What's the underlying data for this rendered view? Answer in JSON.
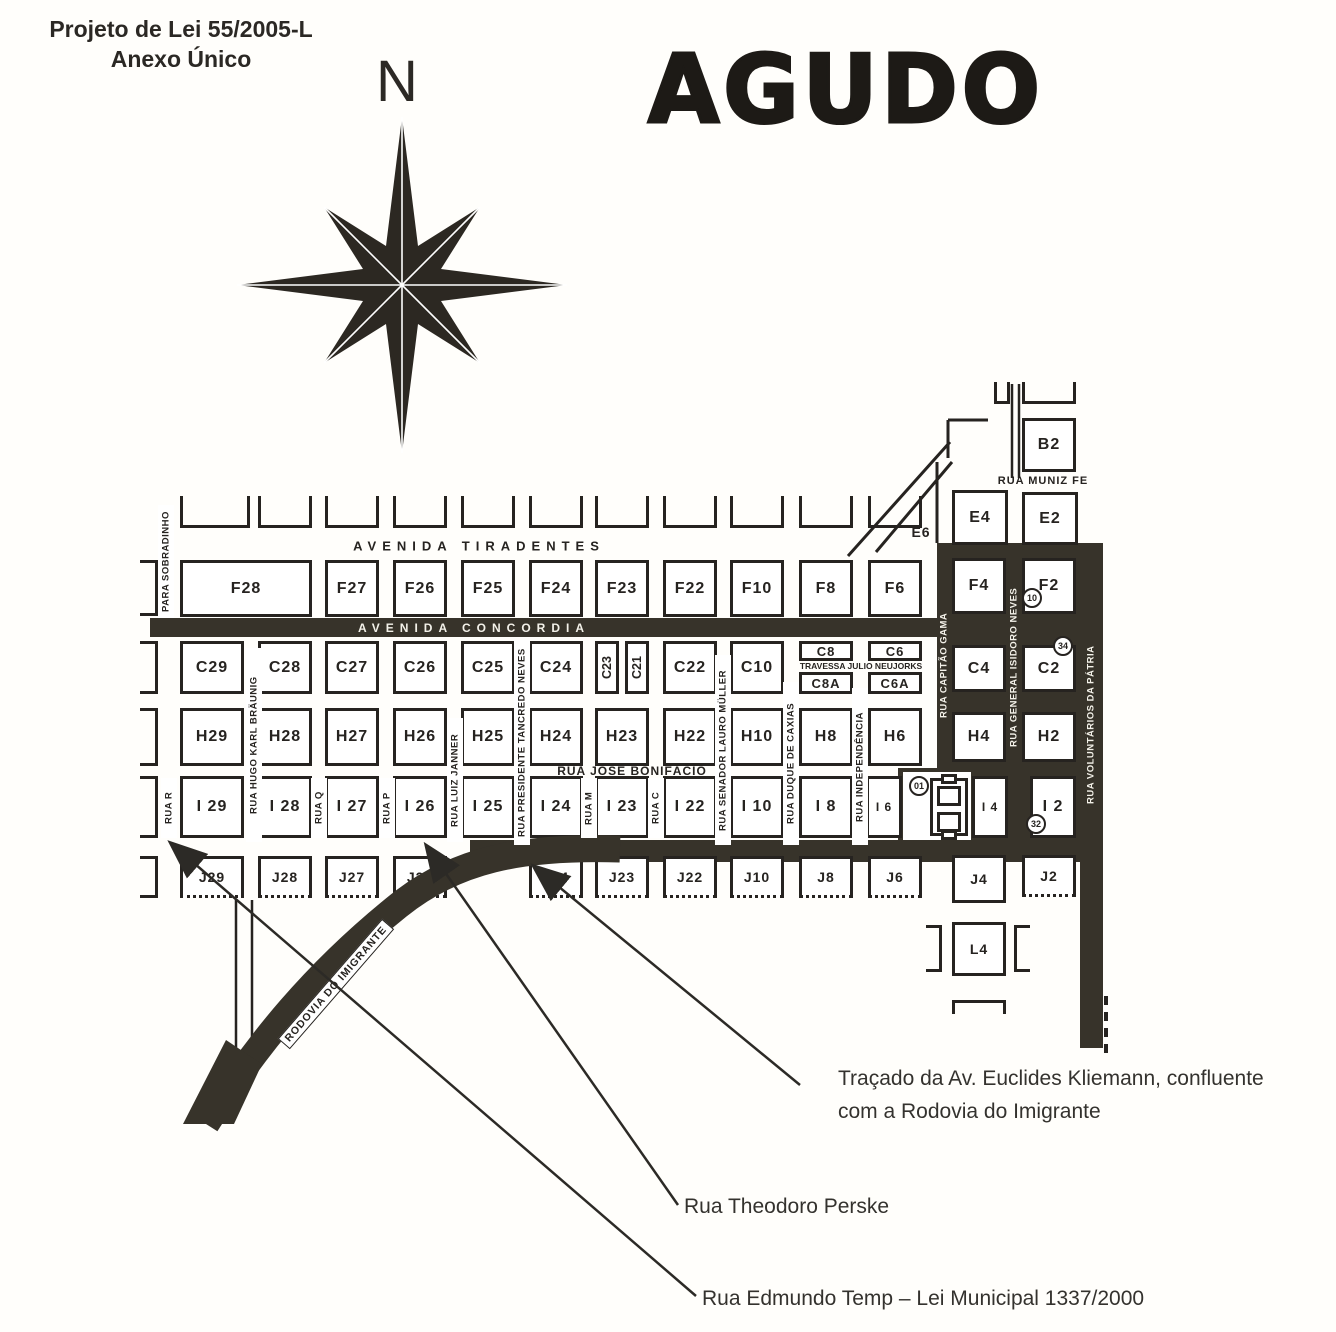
{
  "page": {
    "law_line1": "Projeto de Lei 55/2005-L",
    "law_line2": "Anexo Único",
    "city_title": "AGUDO",
    "compass_letter": "N"
  },
  "map": {
    "ink_color": "#262320",
    "road_color": "#37332a",
    "blocks": [
      {
        "label": "B2",
        "x": 1022,
        "y": 418,
        "w": 54,
        "h": 54
      },
      {
        "label": "E4",
        "x": 952,
        "y": 490,
        "w": 56,
        "h": 55
      },
      {
        "label": "E2",
        "x": 1022,
        "y": 492,
        "w": 56,
        "h": 53
      },
      {
        "label": "F28",
        "x": 180,
        "y": 560,
        "w": 132,
        "h": 57
      },
      {
        "label": "F27",
        "x": 325,
        "y": 560,
        "w": 54,
        "h": 57
      },
      {
        "label": "F26",
        "x": 393,
        "y": 560,
        "w": 54,
        "h": 57
      },
      {
        "label": "F25",
        "x": 461,
        "y": 560,
        "w": 54,
        "h": 57
      },
      {
        "label": "F24",
        "x": 529,
        "y": 560,
        "w": 54,
        "h": 57
      },
      {
        "label": "F23",
        "x": 595,
        "y": 560,
        "w": 54,
        "h": 57
      },
      {
        "label": "F22",
        "x": 663,
        "y": 560,
        "w": 54,
        "h": 57
      },
      {
        "label": "F10",
        "x": 730,
        "y": 560,
        "w": 54,
        "h": 57
      },
      {
        "label": "F8",
        "x": 799,
        "y": 560,
        "w": 54,
        "h": 57
      },
      {
        "label": "F6",
        "x": 868,
        "y": 560,
        "w": 54,
        "h": 57
      },
      {
        "label": "F4",
        "x": 952,
        "y": 558,
        "w": 54,
        "h": 56
      },
      {
        "label": "F2",
        "x": 1022,
        "y": 558,
        "w": 54,
        "h": 56
      },
      {
        "label": "C29",
        "x": 180,
        "y": 641,
        "w": 64,
        "h": 53
      },
      {
        "label": "C28",
        "x": 258,
        "y": 641,
        "w": 54,
        "h": 53
      },
      {
        "label": "C27",
        "x": 325,
        "y": 641,
        "w": 54,
        "h": 53
      },
      {
        "label": "C26",
        "x": 393,
        "y": 641,
        "w": 54,
        "h": 53
      },
      {
        "label": "C25",
        "x": 461,
        "y": 641,
        "w": 54,
        "h": 53
      },
      {
        "label": "C24",
        "x": 529,
        "y": 641,
        "w": 54,
        "h": 53
      },
      {
        "label": "C23",
        "x": 595,
        "y": 641,
        "w": 24,
        "h": 53,
        "vert": true
      },
      {
        "label": "C21",
        "x": 625,
        "y": 641,
        "w": 24,
        "h": 53,
        "vert": true
      },
      {
        "label": "C22",
        "x": 663,
        "y": 641,
        "w": 54,
        "h": 53
      },
      {
        "label": "C10",
        "x": 730,
        "y": 641,
        "w": 54,
        "h": 53
      },
      {
        "label": "C8",
        "x": 799,
        "y": 641,
        "w": 54,
        "h": 20,
        "fs": 13
      },
      {
        "label": "C8A",
        "x": 799,
        "y": 672,
        "w": 54,
        "h": 22,
        "fs": 13
      },
      {
        "label": "C6",
        "x": 868,
        "y": 641,
        "w": 54,
        "h": 20,
        "fs": 13
      },
      {
        "label": "C6A",
        "x": 868,
        "y": 672,
        "w": 54,
        "h": 22,
        "fs": 13
      },
      {
        "label": "C4",
        "x": 952,
        "y": 645,
        "w": 54,
        "h": 47
      },
      {
        "label": "C2",
        "x": 1022,
        "y": 645,
        "w": 54,
        "h": 47
      },
      {
        "label": "H29",
        "x": 180,
        "y": 708,
        "w": 64,
        "h": 58
      },
      {
        "label": "H28",
        "x": 258,
        "y": 708,
        "w": 54,
        "h": 58
      },
      {
        "label": "H27",
        "x": 325,
        "y": 708,
        "w": 54,
        "h": 58
      },
      {
        "label": "H26",
        "x": 393,
        "y": 708,
        "w": 54,
        "h": 58
      },
      {
        "label": "H25",
        "x": 461,
        "y": 708,
        "w": 54,
        "h": 58
      },
      {
        "label": "H24",
        "x": 529,
        "y": 708,
        "w": 54,
        "h": 58
      },
      {
        "label": "H23",
        "x": 595,
        "y": 708,
        "w": 54,
        "h": 58
      },
      {
        "label": "H22",
        "x": 663,
        "y": 708,
        "w": 54,
        "h": 58
      },
      {
        "label": "H10",
        "x": 730,
        "y": 708,
        "w": 54,
        "h": 58
      },
      {
        "label": "H8",
        "x": 799,
        "y": 708,
        "w": 54,
        "h": 58
      },
      {
        "label": "H6",
        "x": 868,
        "y": 708,
        "w": 54,
        "h": 58
      },
      {
        "label": "H4",
        "x": 952,
        "y": 712,
        "w": 54,
        "h": 50
      },
      {
        "label": "H2",
        "x": 1022,
        "y": 712,
        "w": 54,
        "h": 50
      },
      {
        "label": "I 29",
        "x": 180,
        "y": 776,
        "w": 64,
        "h": 62
      },
      {
        "label": "I 28",
        "x": 258,
        "y": 776,
        "w": 54,
        "h": 62
      },
      {
        "label": "I 27",
        "x": 325,
        "y": 776,
        "w": 54,
        "h": 62
      },
      {
        "label": "I 26",
        "x": 393,
        "y": 776,
        "w": 54,
        "h": 62
      },
      {
        "label": "I 25",
        "x": 461,
        "y": 776,
        "w": 54,
        "h": 62
      },
      {
        "label": "I 24",
        "x": 529,
        "y": 776,
        "w": 54,
        "h": 62
      },
      {
        "label": "I 23",
        "x": 595,
        "y": 776,
        "w": 54,
        "h": 62
      },
      {
        "label": "I 22",
        "x": 663,
        "y": 776,
        "w": 54,
        "h": 62
      },
      {
        "label": "I 10",
        "x": 730,
        "y": 776,
        "w": 54,
        "h": 62
      },
      {
        "label": "I 8",
        "x": 799,
        "y": 776,
        "w": 54,
        "h": 62
      },
      {
        "label": "I 6",
        "x": 866,
        "y": 776,
        "w": 36,
        "h": 62,
        "fs": 12
      },
      {
        "label": "I 4",
        "x": 972,
        "y": 776,
        "w": 36,
        "h": 62,
        "fs": 12
      },
      {
        "label": "I 2",
        "x": 1030,
        "y": 776,
        "w": 46,
        "h": 62
      },
      {
        "label": "J29",
        "x": 180,
        "y": 856,
        "w": 64,
        "h": 42,
        "dotted": true,
        "fs": 14
      },
      {
        "label": "J28",
        "x": 258,
        "y": 856,
        "w": 54,
        "h": 42,
        "dotted": true,
        "fs": 14
      },
      {
        "label": "J27",
        "x": 325,
        "y": 856,
        "w": 54,
        "h": 42,
        "dotted": true,
        "fs": 14
      },
      {
        "label": "J26",
        "x": 393,
        "y": 856,
        "w": 54,
        "h": 42,
        "dotted": true,
        "fs": 14
      },
      {
        "label": "J24",
        "x": 529,
        "y": 856,
        "w": 54,
        "h": 42,
        "dotted": true,
        "fs": 14
      },
      {
        "label": "J23",
        "x": 595,
        "y": 856,
        "w": 54,
        "h": 42,
        "dotted": true,
        "fs": 14
      },
      {
        "label": "J22",
        "x": 663,
        "y": 856,
        "w": 54,
        "h": 42,
        "dotted": true,
        "fs": 14
      },
      {
        "label": "J10",
        "x": 730,
        "y": 856,
        "w": 54,
        "h": 42,
        "dotted": true,
        "fs": 14
      },
      {
        "label": "J8",
        "x": 799,
        "y": 856,
        "w": 54,
        "h": 42,
        "dotted": true,
        "fs": 14
      },
      {
        "label": "J6",
        "x": 868,
        "y": 856,
        "w": 54,
        "h": 42,
        "dotted": true,
        "fs": 14
      },
      {
        "label": "J4",
        "x": 952,
        "y": 855,
        "w": 54,
        "h": 48,
        "fs": 14
      },
      {
        "label": "J2",
        "x": 1022,
        "y": 855,
        "w": 54,
        "h": 42,
        "dotted": true,
        "fs": 14
      },
      {
        "label": "L4",
        "x": 952,
        "y": 922,
        "w": 54,
        "h": 54,
        "fs": 14
      }
    ],
    "horizontal_labels": [
      {
        "id": "avenida-tiradentes",
        "text": "AVENIDA   TIRADENTES",
        "x": 479,
        "y": 546,
        "size": 13,
        "ls": 6,
        "color": "dark"
      },
      {
        "id": "avenida-concordia",
        "text": "AVENIDA   CONCORDIA",
        "x": 474,
        "y": 628,
        "size": 12,
        "ls": 6,
        "color": "light"
      },
      {
        "id": "rua-jose-bonifacio",
        "text": "RUA JOSÉ BONIFÁCIO",
        "x": 632,
        "y": 771,
        "size": 12,
        "ls": 1,
        "color": "dark"
      },
      {
        "id": "rua-muniz-fe",
        "text": "RUA MUNIZ FE",
        "x": 1043,
        "y": 481,
        "size": 11,
        "ls": 1,
        "color": "dark"
      },
      {
        "id": "travessa-julio-neujorks",
        "text": "TRAVESSA JULIO NEUJORKS",
        "x": 861,
        "y": 666,
        "size": 8.5,
        "ls": 0,
        "color": "dark"
      },
      {
        "id": "quadra-e6",
        "text": "E6",
        "x": 921,
        "y": 532,
        "size": 14,
        "ls": 1,
        "color": "dark"
      }
    ],
    "vertical_labels": [
      {
        "id": "para-sobradinho",
        "text": "PARA SOBRADINHO",
        "x": 166,
        "y1": 505,
        "y2": 618,
        "color": "dark"
      },
      {
        "id": "rua-r",
        "text": "RUA R",
        "x": 169,
        "y1": 778,
        "y2": 838,
        "color": "dark"
      },
      {
        "id": "rua-hugo-karl-braunig",
        "text": "RUA HUGO KARL BRÄUNIG",
        "x": 254,
        "y1": 648,
        "y2": 842,
        "color": "dark"
      },
      {
        "id": "rua-q",
        "text": "RUA Q",
        "x": 319,
        "y1": 778,
        "y2": 838,
        "color": "dark"
      },
      {
        "id": "rua-p",
        "text": "RUA P",
        "x": 387,
        "y1": 778,
        "y2": 838,
        "color": "dark"
      },
      {
        "id": "rua-luiz-janner",
        "text": "RUA LUIZ JANNER",
        "x": 455,
        "y1": 718,
        "y2": 842,
        "color": "dark"
      },
      {
        "id": "rua-presidente-tancredo-neves",
        "text": "RUA PRESIDENTE TANCREDO NEVES",
        "x": 522,
        "y1": 640,
        "y2": 845,
        "color": "dark"
      },
      {
        "id": "rua-m",
        "text": "RUA M",
        "x": 589,
        "y1": 778,
        "y2": 838,
        "color": "dark"
      },
      {
        "id": "rua-c",
        "text": "RUA C",
        "x": 656,
        "y1": 778,
        "y2": 838,
        "color": "dark"
      },
      {
        "id": "rua-senador-lauro-muller",
        "text": "RUA SENADOR LAURO MÜLLER",
        "x": 723,
        "y1": 655,
        "y2": 845,
        "color": "dark"
      },
      {
        "id": "rua-duque-de-caxias",
        "text": "RUA DUQUE DE CAXIAS",
        "x": 791,
        "y1": 682,
        "y2": 845,
        "color": "dark"
      },
      {
        "id": "rua-independencia",
        "text": "RUA INDEPENDÊNCIA",
        "x": 860,
        "y1": 688,
        "y2": 845,
        "color": "dark"
      },
      {
        "id": "rua-capitao-gama",
        "text": "RUA CAPITÃO GAMA",
        "x": 944,
        "y1": 556,
        "y2": 775,
        "color": "light"
      },
      {
        "id": "rua-general-isidoro-neves",
        "text": "RUA GENERAL ISIDORO NEVES",
        "x": 1014,
        "y1": 552,
        "y2": 782,
        "color": "light"
      },
      {
        "id": "rua-voluntarios-da-patria",
        "text": "RUA VOLUNTÁRIOS DA PÁTRIA",
        "x": 1091,
        "y1": 598,
        "y2": 852,
        "color": "light"
      }
    ],
    "rodovia_label": {
      "text": "RODOVIA DO IMIGRANTE",
      "x": 336,
      "y": 984,
      "angle": -49
    },
    "badges": [
      {
        "text": "10",
        "x": 1032,
        "y": 598
      },
      {
        "text": "34",
        "x": 1063,
        "y": 646
      },
      {
        "text": "01",
        "x": 919,
        "y": 786
      },
      {
        "text": "32",
        "x": 1036,
        "y": 824
      }
    ]
  },
  "annotations": [
    {
      "id": "note-kliemann",
      "lines": [
        "Traçado da Av. Euclides Kliemann, confluente",
        "com a Rodovia do Imigrante"
      ],
      "tx": 838,
      "ty": 1062,
      "line": {
        "x1": 800,
        "y1": 1085,
        "x2": 536,
        "y2": 868
      }
    },
    {
      "id": "note-theodoro-perske",
      "lines": [
        "Rua Theodoro Perske"
      ],
      "tx": 684,
      "ty": 1190,
      "line": {
        "x1": 678,
        "y1": 1205,
        "x2": 428,
        "y2": 848
      }
    },
    {
      "id": "note-edmundo-temp",
      "lines": [
        "Rua Edmundo Temp – Lei Municipal 1337/2000"
      ],
      "tx": 702,
      "ty": 1282,
      "line": {
        "x1": 696,
        "y1": 1296,
        "x2": 173,
        "y2": 845
      }
    }
  ]
}
